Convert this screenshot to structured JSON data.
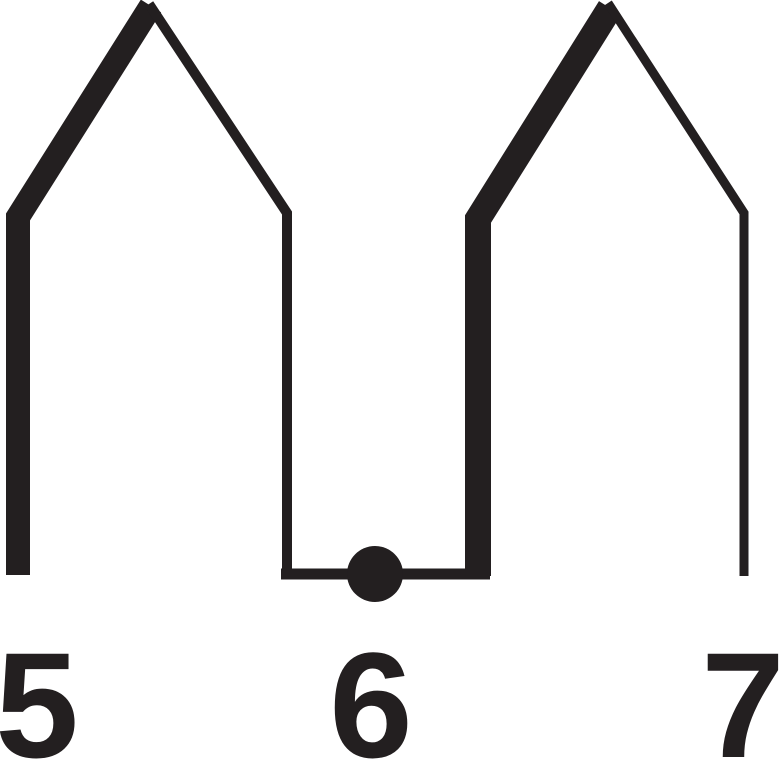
{
  "figure": {
    "description": "Line-art diagram of two peaked hills above a number line; a filled dot rests on the valley baseline at the value 6",
    "ink_color": "#231f20",
    "background_color": "#ffffff",
    "marked_point_value": "6",
    "tick_labels": [
      {
        "text": "5",
        "cx": 37,
        "y": 757
      },
      {
        "text": "6",
        "cx": 371,
        "y": 757
      },
      {
        "text": "7",
        "cx": 743,
        "y": 757
      }
    ],
    "polylines": [
      {
        "name": "left-hill-thick-stroke",
        "points": [
          [
            18,
            575
          ],
          [
            18,
            217
          ],
          [
            151,
            6
          ]
        ],
        "width": 24
      },
      {
        "name": "left-hill-thin-stroke",
        "points": [
          [
            149,
            4
          ],
          [
            287,
            213
          ],
          [
            287,
            576
          ]
        ],
        "width": 10
      },
      {
        "name": "valley-baseline",
        "points": [
          [
            281,
            574
          ],
          [
            490,
            574
          ]
        ],
        "width": 11
      },
      {
        "name": "right-hill-thick-stroke",
        "points": [
          [
            478,
            576
          ],
          [
            478,
            219
          ],
          [
            610,
            8
          ]
        ],
        "width": 26
      },
      {
        "name": "right-hill-thin-stroke",
        "points": [
          [
            608,
            3
          ],
          [
            744,
            213
          ],
          [
            744,
            576
          ]
        ],
        "width": 9
      }
    ],
    "dot": {
      "cx": 375,
      "cy": 574,
      "r": 28
    }
  }
}
